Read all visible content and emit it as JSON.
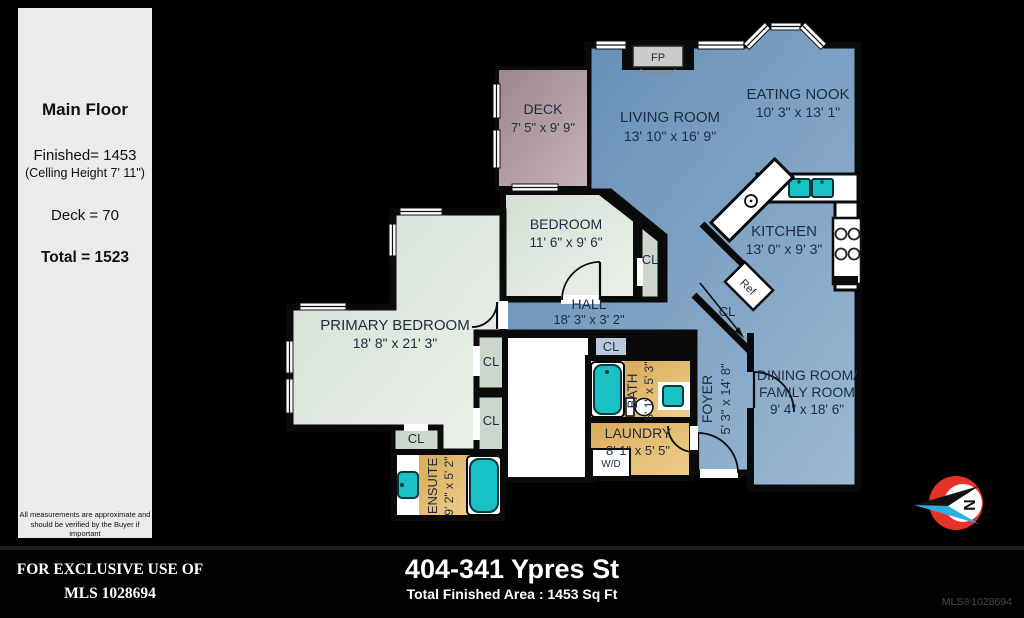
{
  "info_panel": {
    "title": "Main Floor",
    "finished_line": "Finished= 1453",
    "ceiling_line": "(Celling Height 7' 11\")",
    "deck_line": "Deck = 70",
    "total_line": "Total = 1523",
    "disclaimer_line1": "All measurements are approximate and",
    "disclaimer_line2": "should be verified by the Buyer if important"
  },
  "plan": {
    "rooms": {
      "deck": {
        "name": "DECK",
        "dims": "7' 5\" x 9' 9\""
      },
      "living": {
        "name": "LIVING ROOM",
        "dims": "13' 10\" x 16' 9\""
      },
      "nook": {
        "name": "EATING NOOK",
        "dims": "10' 3\" x 13' 1\""
      },
      "kitchen": {
        "name": "KITCHEN",
        "dims": "13' 0\" x 9' 3\""
      },
      "bedroom": {
        "name": "BEDROOM",
        "dims": "11' 6\" x 9' 6\""
      },
      "hall": {
        "name": "HALL",
        "dims": "18' 3\" x 3' 2\""
      },
      "primary": {
        "name": "PRIMARY BEDROOM",
        "dims": "18' 8\" x 21' 3\""
      },
      "dining": {
        "name_line1": "DINING ROOM/",
        "name_line2": "FAMILY ROOM",
        "dims": "9' 4\" x 18' 6\""
      },
      "foyer": {
        "name": "FOYER",
        "dims": "5' 3\" x 14' 8\""
      },
      "bath": {
        "name": "BATH",
        "dims": "8' 1\" x 5' 3\""
      },
      "laundry": {
        "name": "LAUNDRY",
        "dims": "8' 1\" x 5' 5\""
      },
      "ensuite": {
        "name": "ENSUITE",
        "dims": "9' 2\" x 5' 2\""
      }
    },
    "labels": {
      "closet": "CL",
      "fridge": "Ref",
      "washer_dryer": "W/D",
      "fireplace": "FP",
      "north": "N"
    }
  },
  "footer": {
    "exclusive_line1": "FOR EXCLUSIVE USE OF",
    "exclusive_line2": "MLS 1028694",
    "address": "404-341 Ypres St",
    "area_line": "Total Finished Area : 1453 Sq Ft",
    "mls_small": "MLS®1028694"
  },
  "colors": {
    "plan_blue": "#6a92b8",
    "plan_green": "#dde7dc",
    "plan_gold": "#e2b667",
    "plan_mauve": "#b29ba1",
    "fixture_teal": "#17c1c4",
    "compass_red": "#e63228",
    "compass_cyan": "#2bb1e0",
    "wall": "#0a0a0a"
  }
}
